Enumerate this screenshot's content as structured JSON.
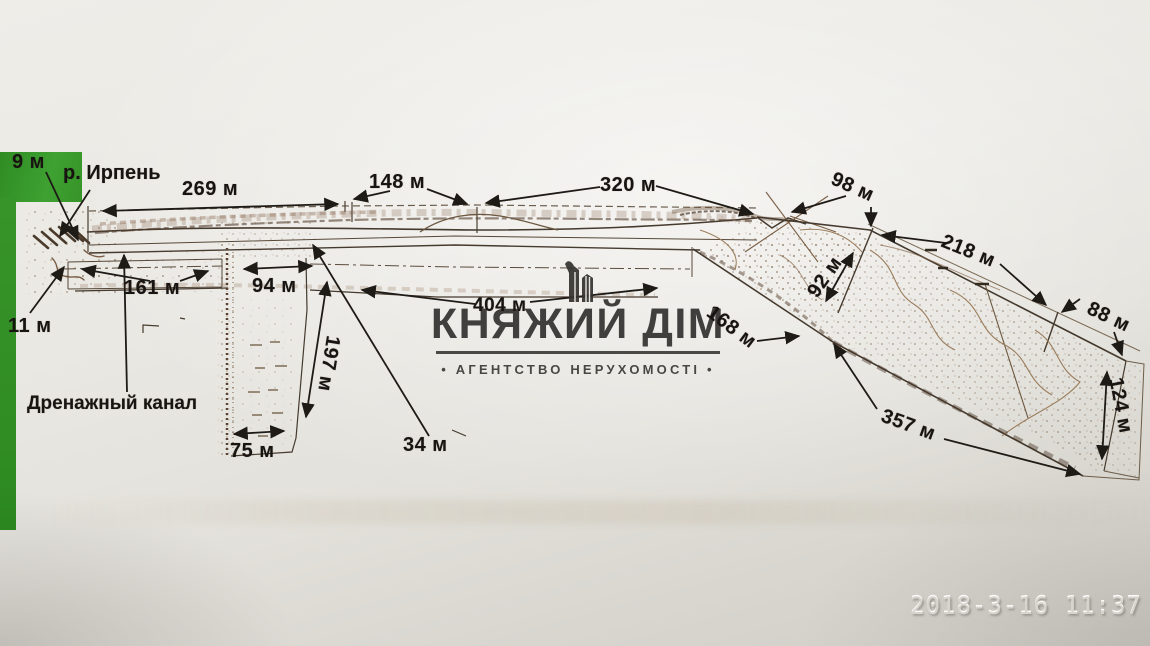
{
  "watermark": {
    "title": "КНЯЖИЙ ДІМ",
    "subtitle": "• АГЕНТСТВО НЕРУХОМОСТІ •"
  },
  "camera": {
    "timestamp": "2018-3-16 11:37"
  },
  "plan": {
    "river_label": "р. Ирпень",
    "drainage_label": "Дренажный канал",
    "dims": {
      "d9": "9 м",
      "d11": "11 м",
      "d269": "269 м",
      "d148": "148 м",
      "d320": "320 м",
      "d98": "98 м",
      "d218": "218 м",
      "d88": "88 м",
      "d92": "92 м",
      "d161": "161 м",
      "d94": "94 м",
      "d404": "404 м",
      "d168": "168 м",
      "d197": "197 м",
      "d75": "75 м",
      "d34": "34 м",
      "d357": "357 м",
      "d124": "124 м"
    }
  },
  "colors": {
    "paper": "#e8e6e0",
    "green_backdrop": "#379428",
    "ink": "#181411",
    "scan_brown": "#8a6a4f",
    "watermark_gray": "#34322f",
    "timestamp_gray": "#d6d4cd"
  }
}
